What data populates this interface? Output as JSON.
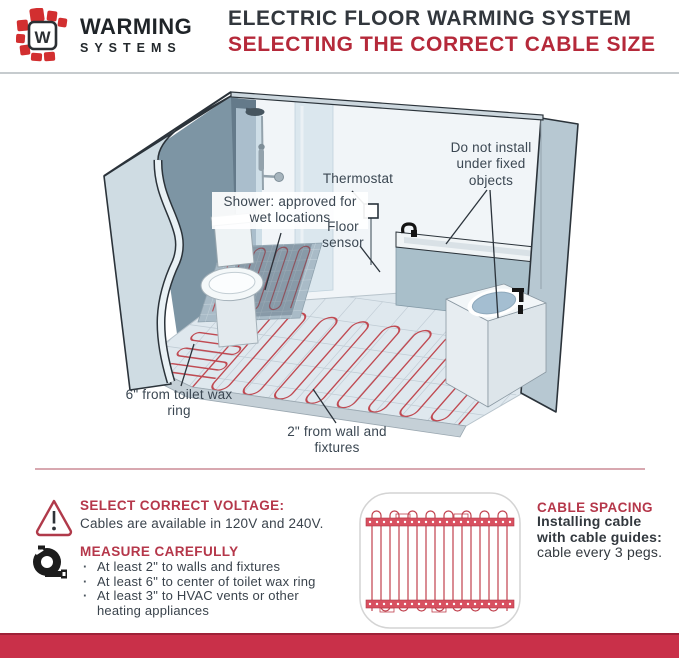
{
  "colors": {
    "accent_red": "#b5293a",
    "logo_red": "#d22f30",
    "footer_red": "#c93049",
    "cable_red": "#c04a52",
    "dark_text": "#32383e",
    "label_text": "#3b4752"
  },
  "header": {
    "brand": {
      "monogram": "W",
      "line1": "WARMING",
      "line2": "SYSTEMS"
    },
    "title": "ELECTRIC FLOOR WARMING SYSTEM",
    "subtitle": "SELECTING THE CORRECT CABLE SIZE"
  },
  "diagram": {
    "labels": {
      "shower": "Shower: approved for wet locations",
      "thermostat": "Thermostat",
      "floor_sensor": "Floor sensor",
      "fixed_objects": "Do not install under fixed objects",
      "toilet_clearance": "6\" from toilet wax ring",
      "wall_clearance": "2\" from wall and fixtures"
    }
  },
  "tips": {
    "voltage": {
      "title": "SELECT CORRECT VOLTAGE:",
      "body": "Cables are available in 120V and 240V."
    },
    "measure": {
      "title": "MEASURE CAREFULLY",
      "bullets": [
        "At least 2\" to walls and fixtures",
        "At least 6\" to center of toilet wax ring",
        "At least 3\" to HVAC vents or other heating appliances"
      ]
    }
  },
  "cable_spacing": {
    "title": "CABLE SPACING",
    "lead_bold": "Installing cable with cable guides:",
    "lead_rest": "cable every 3 pegs."
  }
}
